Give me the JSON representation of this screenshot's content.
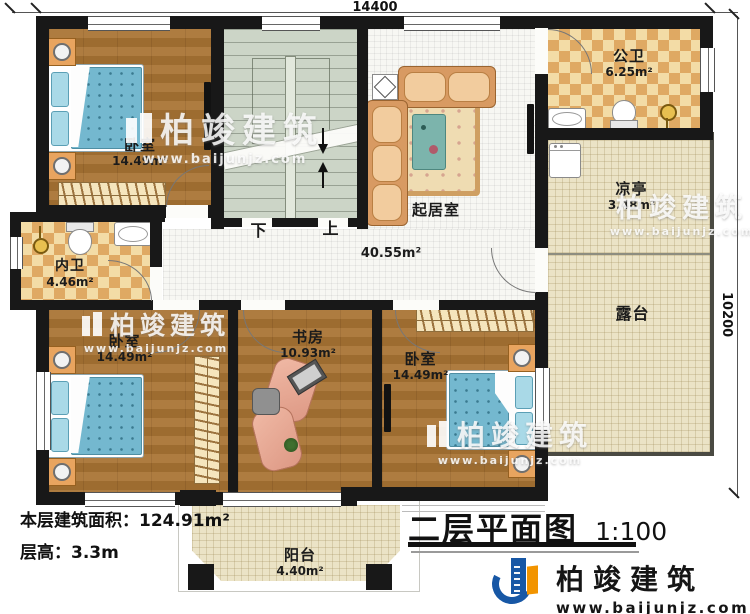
{
  "title": {
    "text": "二层平面图",
    "scale": "1:100"
  },
  "info": {
    "floor_area_label": "本层建筑面积：",
    "floor_area_value": "124.91m²",
    "floor_height_label": "层高：",
    "floor_height_value": "3.3m"
  },
  "dimensions": {
    "width": "14400",
    "height": "10200"
  },
  "stairs": {
    "down": "下",
    "up": "上"
  },
  "rooms": {
    "bedroom_tl": {
      "name": "卧室",
      "area": "14.49m²"
    },
    "inner_bath": {
      "name": "内卫",
      "area": "4.46m²"
    },
    "bedroom_bl": {
      "name": "卧室",
      "area": "14.49m²"
    },
    "study": {
      "name": "书房",
      "area": "10.93m²"
    },
    "bedroom_br": {
      "name": "卧室",
      "area": "14.49m²"
    },
    "living": {
      "name": "起居室",
      "area": "40.55m²"
    },
    "public_bath": {
      "name": "公卫",
      "area": "6.25m²"
    },
    "pavilion": {
      "name": "凉亭",
      "area": "3.48m²"
    },
    "terrace": {
      "name": "露台"
    },
    "balcony": {
      "name": "阳台",
      "area": "4.40m²"
    }
  },
  "brand": {
    "name": "柏竣建筑",
    "url": "www.baijunjz.com"
  },
  "colors": {
    "wall": "#181818",
    "logo_blue": "#1757a5",
    "logo_orange": "#f29400",
    "wood_floor": "#a97434",
    "tile": "#dfa963",
    "stair_floor": "#ccd5c7",
    "terrace_floor": "#ebe3c6",
    "bed": "#74b8cf"
  }
}
